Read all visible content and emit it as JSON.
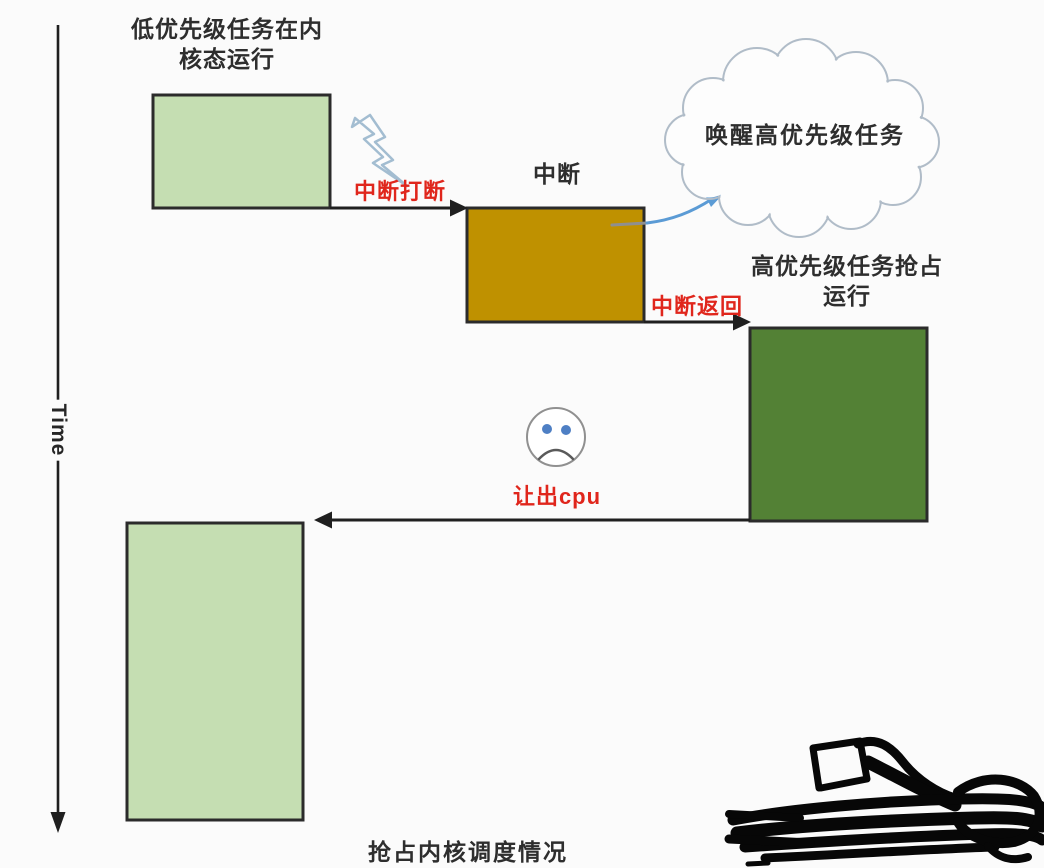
{
  "diagram": {
    "caption": "抢占内核调度情况",
    "time_axis": {
      "label": "Time"
    },
    "nodes": {
      "low_task": {
        "label": "低优先级任务在内\n核态运行",
        "fill": "#c5deb2"
      },
      "interrupt": {
        "label": "中断",
        "fill": "#bf9100"
      },
      "high_task": {
        "label": "高优先级任务抢占\n运行",
        "fill": "#538135"
      },
      "low_task_resume": {
        "fill": "#c5deb2"
      },
      "wake_cloud": {
        "label": "唤醒高优先级任务"
      }
    },
    "edge_labels": {
      "interrupt_break": "中断打断",
      "interrupt_return": "中断返回",
      "yield_cpu": "让出cpu"
    },
    "icons": {
      "lightning": "lightning-bolt-outline",
      "cloud": "thought-cloud",
      "sad_face": "sad-face",
      "scribble": "black-marker-scribble"
    },
    "colors": {
      "light_green_box": "#c5deb2",
      "gold_box": "#bf9100",
      "dark_green_box": "#538135",
      "box_border": "#2b2b2b",
      "edge_label_red": "#e0261c",
      "wake_arrow_blue": "#5b9bd5",
      "lightning_stroke": "#a3bdd1",
      "cloud_stroke": "#b0bcc8",
      "flow_line": "#1f1f1f"
    }
  }
}
